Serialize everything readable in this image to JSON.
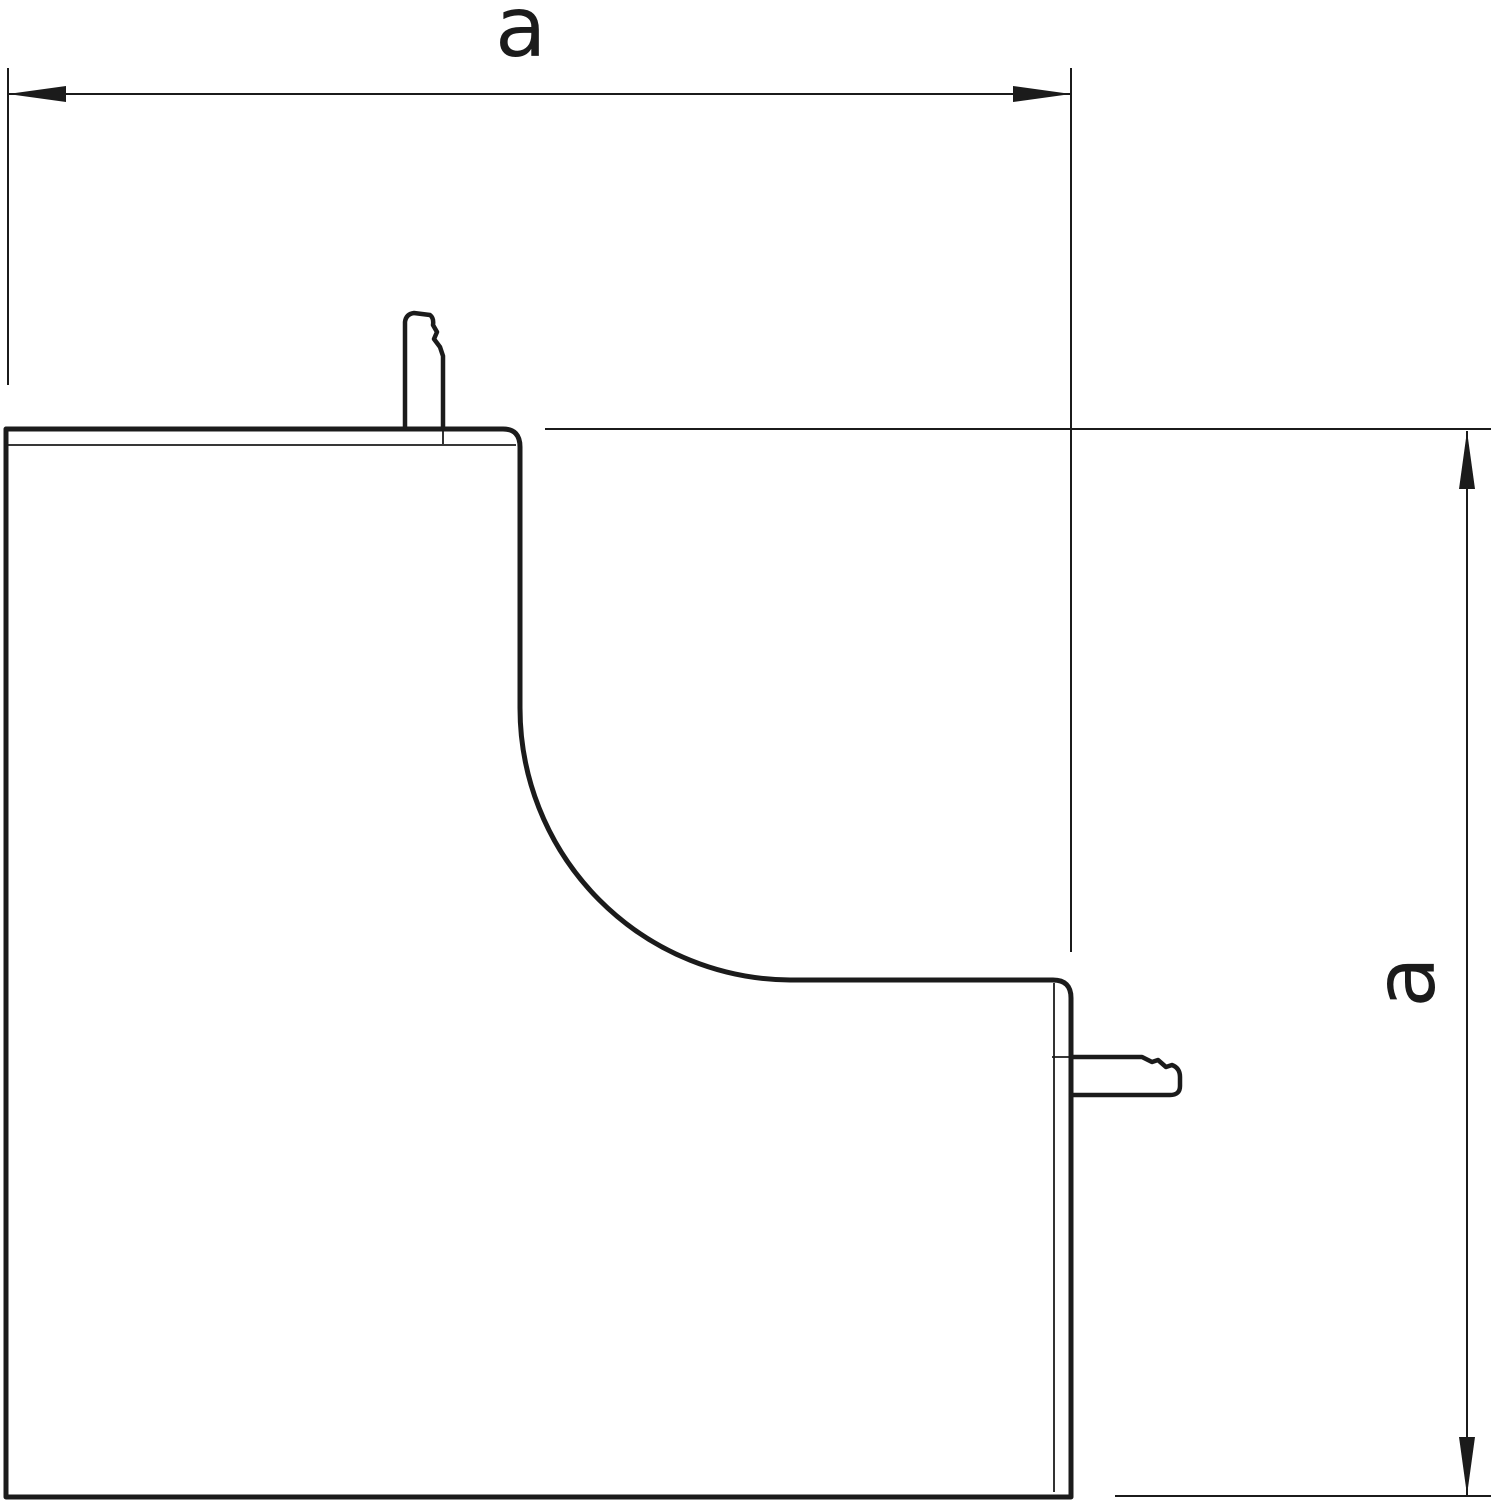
{
  "drawing": {
    "kind": "dimensioned technical line drawing of an internal corner cover piece",
    "horizontal_dimension": {
      "label": "a"
    },
    "vertical_dimension": {
      "label": "a"
    },
    "colors": {
      "line": "#1b1b1b",
      "background": "#ffffff"
    }
  }
}
